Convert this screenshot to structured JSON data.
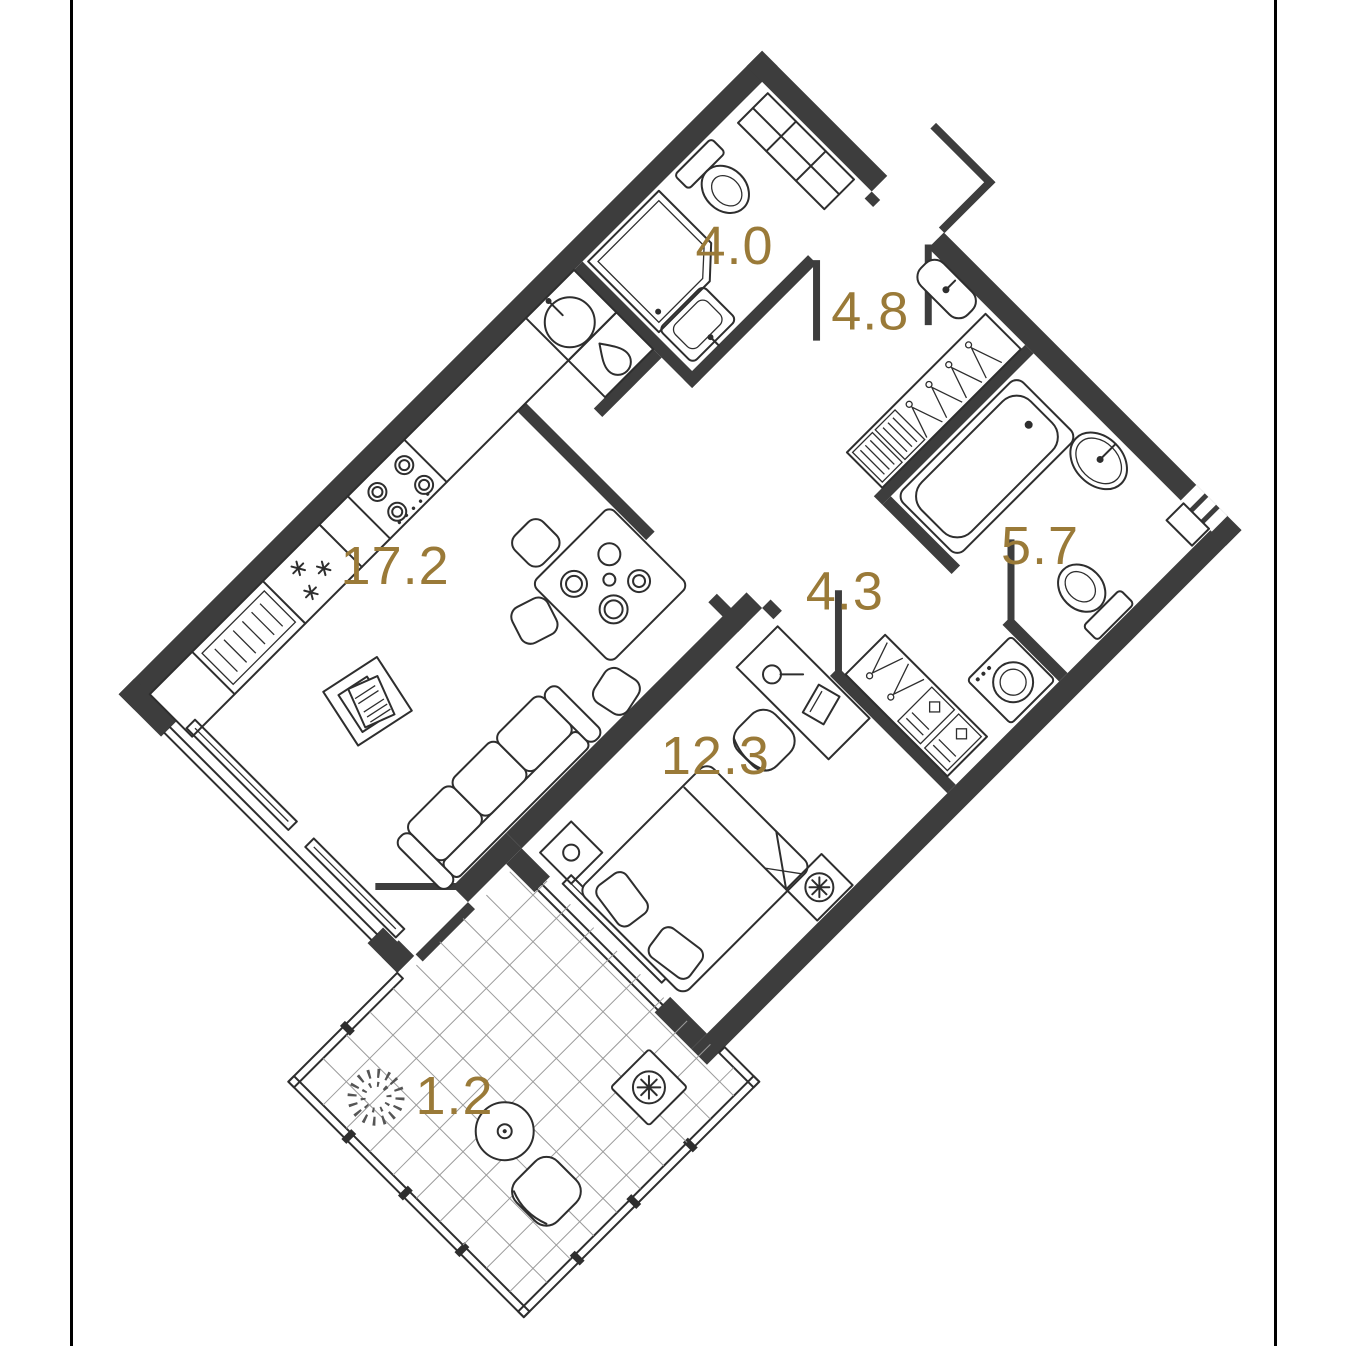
{
  "image": {
    "type": "apartment floor plan, rotated 45 degrees",
    "background": "#ffffff",
    "frame_color": "#000000",
    "plan_rotation_deg": -45
  },
  "colors": {
    "walls": "#3d3d3d",
    "furniture_lines": "#2e2e2e",
    "area_labels": "#9a7a38",
    "balcony_tiles": "#9b9b9b"
  },
  "rooms": [
    {
      "name": "kitchen-living-room",
      "area_label": "17.2"
    },
    {
      "name": "bathroom",
      "area_label": "4.0"
    },
    {
      "name": "entrance-hall",
      "area_label": "4.8"
    },
    {
      "name": "corridor",
      "area_label": "4.3"
    },
    {
      "name": "bathroom-2",
      "area_label": "5.7"
    },
    {
      "name": "bedroom",
      "area_label": "12.3"
    },
    {
      "name": "balcony",
      "area_label": "1.2"
    }
  ],
  "furniture_icons": [
    "kitchen-counter",
    "dish-rack",
    "refrigerator-snowflakes",
    "cooktop-4-burner",
    "kitchen-sink",
    "dishwasher-droplet",
    "dining-table",
    "chair",
    "sofa",
    "coffee-table",
    "radiator",
    "window",
    "shower-stall",
    "toilet",
    "shelf-unit",
    "bath-sink",
    "entry-wall-basin",
    "hall-wardrobe-hangers",
    "shoe-boxes",
    "corridor-wardrobe-hangers",
    "bathtub",
    "oval-basin",
    "washing-machine",
    "double-bed",
    "pillows",
    "nightstand",
    "desk",
    "desk-chair",
    "desk-lamp",
    "laptop",
    "ac-fan-unit",
    "balcony-table",
    "balcony-chair",
    "potted-plant",
    "tile-floor",
    "entrance-door",
    "door-leaf",
    "balcony-glazing",
    "threshold"
  ]
}
